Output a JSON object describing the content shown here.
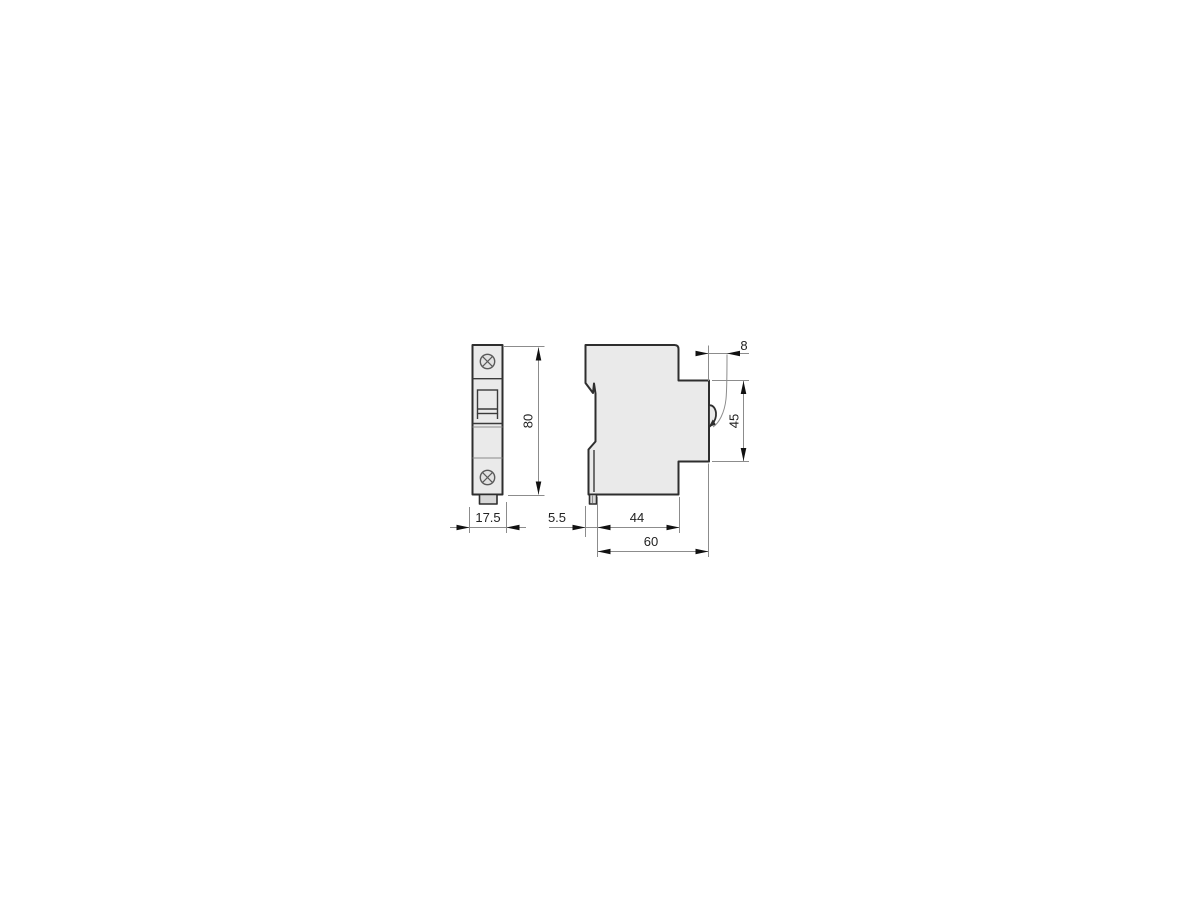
{
  "drawing": {
    "type": "technical-dimension-drawing",
    "subject": "1-pole miniature circuit breaker, front and side view",
    "dimensions": {
      "width": "17.5",
      "height": "80",
      "rail_offset": "5.5",
      "base_depth": "44",
      "total_depth": "60",
      "handle_offset": "8",
      "front_height": "45"
    },
    "colors": {
      "background": "#ffffff",
      "body_fill": "#eaeaea",
      "foot_fill": "#d7d7d7",
      "outline": "#2e2e2e",
      "dimension_lines": "#8c8c8c",
      "arrowheads": "#111111",
      "text": "#222222"
    }
  }
}
